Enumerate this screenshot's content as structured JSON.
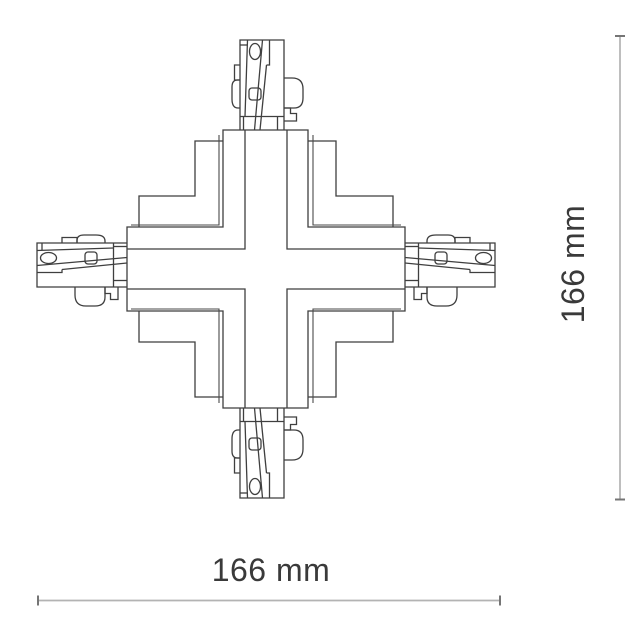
{
  "drawing": {
    "kind": "technical-line-drawing",
    "subject": "x-cross-track-connector-top-view"
  },
  "dimensions": {
    "width": {
      "label": "166 mm"
    },
    "height": {
      "label": "166 mm"
    }
  },
  "colors": {
    "background": "#ffffff",
    "drawing_line": "#3f3f3f",
    "dimension_line": "#b3b3b3",
    "dimension_tick": "#757575",
    "dimension_text": "#3a3a3a"
  }
}
